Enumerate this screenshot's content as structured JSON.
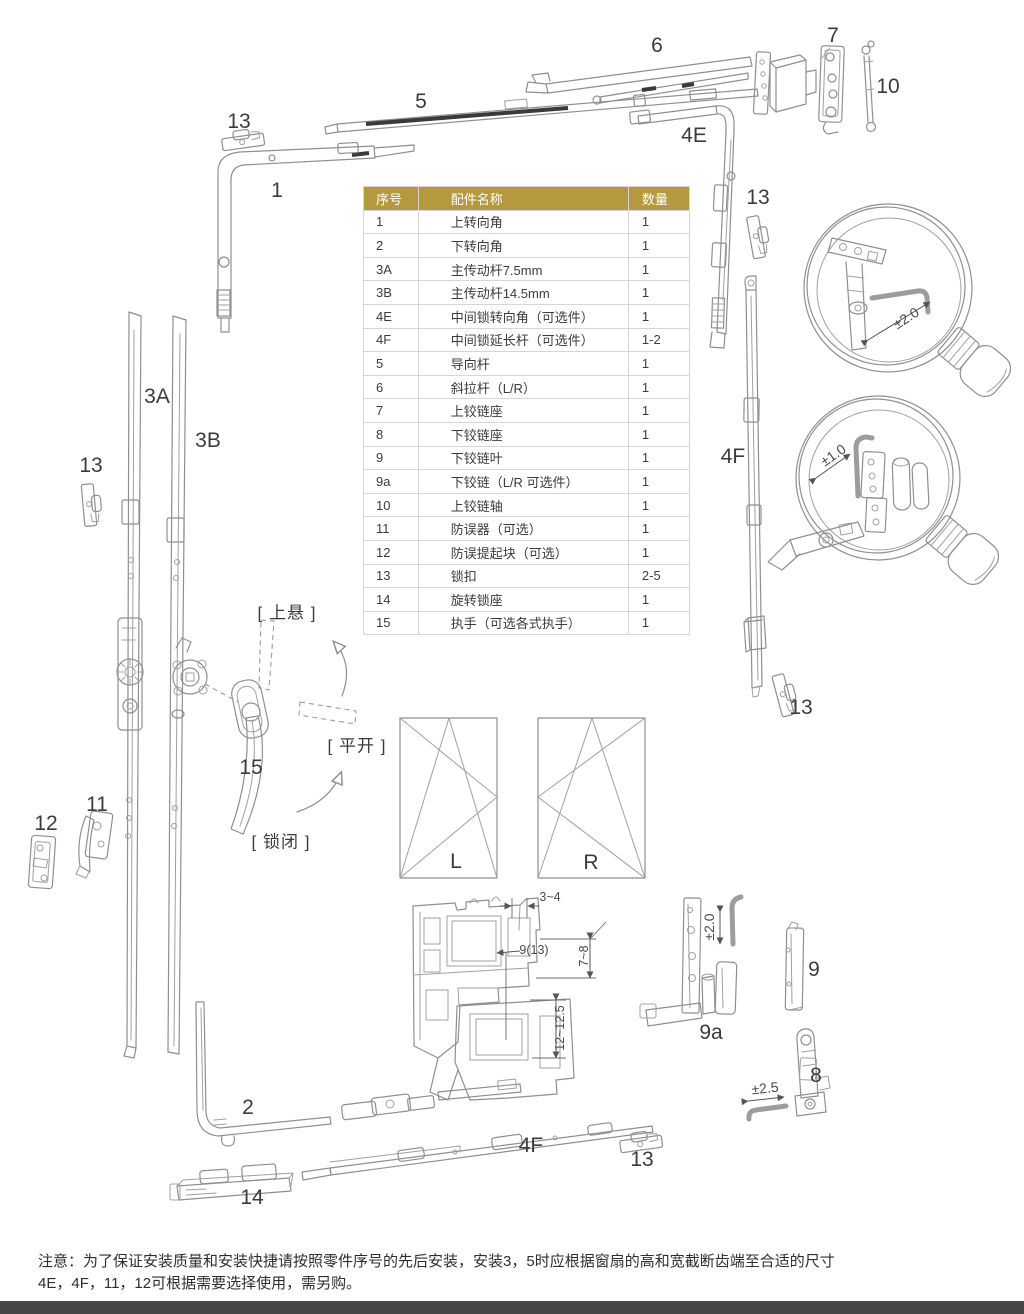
{
  "table": {
    "headers": [
      "序号",
      "配件名称",
      "数量"
    ],
    "rows": [
      [
        "1",
        "上转向角",
        "1"
      ],
      [
        "2",
        "下转向角",
        "1"
      ],
      [
        "3A",
        "主传动杆7.5mm",
        "1"
      ],
      [
        "3B",
        "主传动杆14.5mm",
        "1"
      ],
      [
        "4E",
        "中间锁转向角（可选件）",
        "1"
      ],
      [
        "4F",
        "中间锁延长杆（可选件）",
        "1-2"
      ],
      [
        "5",
        "导向杆",
        "1"
      ],
      [
        "6",
        "斜拉杆（L/R）",
        "1"
      ],
      [
        "7",
        "上铰链座",
        "1"
      ],
      [
        "8",
        "下铰链座",
        "1"
      ],
      [
        "9",
        "下铰链叶",
        "1"
      ],
      [
        "9a",
        "下铰链（L/R 可选件）",
        "1"
      ],
      [
        "10",
        "上铰链轴",
        "1"
      ],
      [
        "11",
        "防误器（可选）",
        "1"
      ],
      [
        "12",
        "防误提起块（可选）",
        "1"
      ],
      [
        "13",
        "锁扣",
        "2-5"
      ],
      [
        "14",
        "旋转锁座",
        "1"
      ],
      [
        "15",
        "执手（可选各式执手）",
        "1"
      ]
    ]
  },
  "labels": [
    {
      "t": "13",
      "x": 239,
      "y": 122,
      "c": "num"
    },
    {
      "t": "1",
      "x": 277,
      "y": 191,
      "c": "num"
    },
    {
      "t": "5",
      "x": 421,
      "y": 102,
      "c": "num"
    },
    {
      "t": "6",
      "x": 657,
      "y": 46,
      "c": "num"
    },
    {
      "t": "4E",
      "x": 694,
      "y": 136,
      "c": "num"
    },
    {
      "t": "7",
      "x": 833,
      "y": 36,
      "c": "num"
    },
    {
      "t": "10",
      "x": 888,
      "y": 87,
      "c": "num"
    },
    {
      "t": "13",
      "x": 758,
      "y": 198,
      "c": "num"
    },
    {
      "t": "3A",
      "x": 157,
      "y": 397,
      "c": "num"
    },
    {
      "t": "3B",
      "x": 208,
      "y": 441,
      "c": "num"
    },
    {
      "t": "13",
      "x": 91,
      "y": 466,
      "c": "num"
    },
    {
      "t": "4F",
      "x": 733,
      "y": 457,
      "c": "num"
    },
    {
      "t": "13",
      "x": 801,
      "y": 708,
      "c": "num"
    },
    {
      "t": "15",
      "x": 251,
      "y": 768,
      "c": "num"
    },
    {
      "t": "11",
      "x": 97,
      "y": 805,
      "c": "num"
    },
    {
      "t": "12",
      "x": 46,
      "y": 824,
      "c": "num"
    },
    {
      "t": "2",
      "x": 248,
      "y": 1108,
      "c": "num"
    },
    {
      "t": "14",
      "x": 252,
      "y": 1198,
      "c": "num"
    },
    {
      "t": "4F",
      "x": 531,
      "y": 1146,
      "c": "num"
    },
    {
      "t": "13",
      "x": 642,
      "y": 1160,
      "c": "num"
    },
    {
      "t": "9a",
      "x": 711,
      "y": 1033,
      "c": "num"
    },
    {
      "t": "9",
      "x": 814,
      "y": 970,
      "c": "num"
    },
    {
      "t": "8",
      "x": 816,
      "y": 1076,
      "c": "num"
    },
    {
      "t": "L",
      "x": 456,
      "y": 862,
      "c": "num"
    },
    {
      "t": "R",
      "x": 591,
      "y": 863,
      "c": "num"
    },
    {
      "t": "[ 上悬 ]",
      "x": 287,
      "y": 611,
      "c": "ann"
    },
    {
      "t": "[ 平开 ]",
      "x": 357,
      "y": 744,
      "c": "ann"
    },
    {
      "t": "[ 锁闭 ]",
      "x": 281,
      "y": 840,
      "c": "ann"
    },
    {
      "t": "±2.0",
      "x": 906,
      "y": 318,
      "c": "dim",
      "r": -33
    },
    {
      "t": "±1.0",
      "x": 833,
      "y": 455,
      "c": "dim",
      "r": -35
    },
    {
      "t": "±2.0",
      "x": 709,
      "y": 927,
      "c": "dim",
      "r": -90
    },
    {
      "t": "±2.5",
      "x": 765,
      "y": 1088,
      "c": "dim",
      "r": -6
    },
    {
      "t": "3~4",
      "x": 550,
      "y": 897,
      "c": "dimS"
    },
    {
      "t": "9(13)",
      "x": 534,
      "y": 950,
      "c": "dimS"
    },
    {
      "t": "7~8",
      "x": 584,
      "y": 956,
      "c": "dimS",
      "r": -90
    },
    {
      "t": "12~12.5",
      "x": 560,
      "y": 1028,
      "c": "dimS",
      "r": -90
    }
  ],
  "note": {
    "line1": "注意：为了保证安装质量和安装快捷请按照零件序号的先后安装，安装3，5时应根据窗扇的高和宽截断齿端至合适的尺寸",
    "line2": "4E，4F，11，12可根据需要选择使用，需另购。"
  },
  "colors": {
    "header_bg": "#b6983f",
    "header_text": "#ffffff",
    "line_art": "#8f8f8f",
    "dark_accent": "#3a3a3a",
    "table_border": "#d6d6d6",
    "footer_bar": "#474747"
  }
}
